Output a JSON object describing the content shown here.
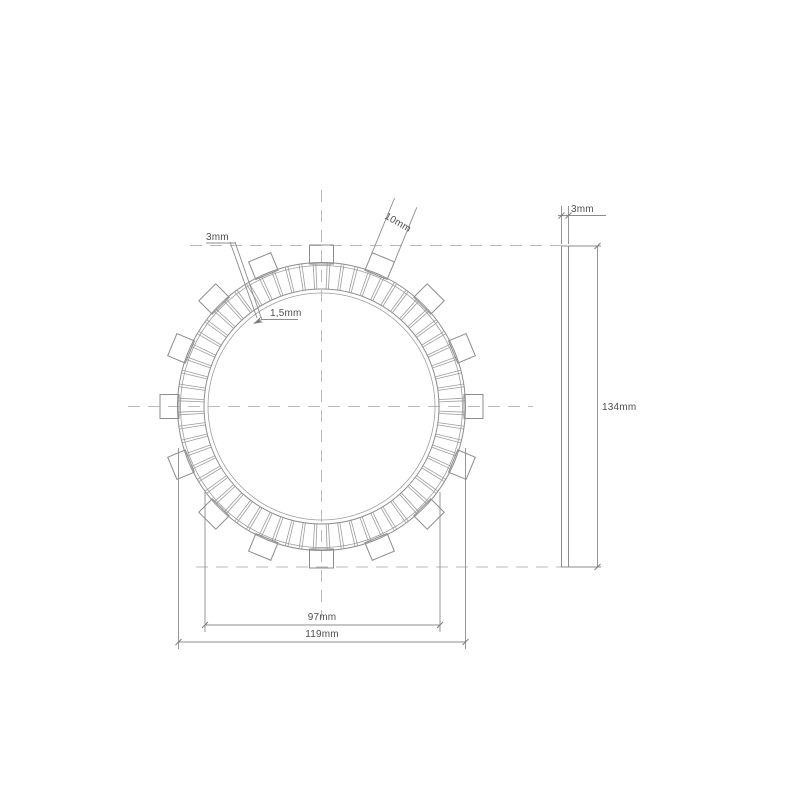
{
  "annotations": {
    "groove_width_outer": "3mm",
    "tab_width": "10mm",
    "groove_width_inner": "1,5mm",
    "friction_inner_diameter": "97mm",
    "friction_outer_diameter": "119mm",
    "plate_thickness": "3mm",
    "overall_diameter": "134mm"
  },
  "colors": {
    "line": "#8c8c8c",
    "dash": "#b9b9b9",
    "text": "#4f4f4f",
    "background": "#ffffff"
  },
  "geometry": {
    "front_center": {
      "x": 321.5,
      "y": 406.5
    },
    "radii": {
      "pad_outer": 144,
      "core_outer": 141,
      "pad_inner": 117.5,
      "core_inner": 113.5,
      "tab_outer": 161.5,
      "tab_inner": 142.5
    },
    "tabs": {
      "count": 16,
      "width": 24
    },
    "grooves": {
      "count": 64,
      "half_angle_deg": 0.55,
      "offset_deg": 2.8125
    },
    "side_view": {
      "left": 561.5,
      "right": 568.5,
      "top": 246,
      "bottom": 567
    },
    "centerlines": [
      {
        "x1": 321.5,
        "y1": 190,
        "x2": 321.5,
        "y2": 618
      },
      {
        "x1": 128,
        "y1": 406.5,
        "x2": 533,
        "y2": 406.5
      },
      {
        "x1": 190,
        "y1": 245.5,
        "x2": 561,
        "y2": 245.5
      },
      {
        "x1": 196,
        "y1": 567,
        "x2": 561,
        "y2": 567
      }
    ]
  }
}
